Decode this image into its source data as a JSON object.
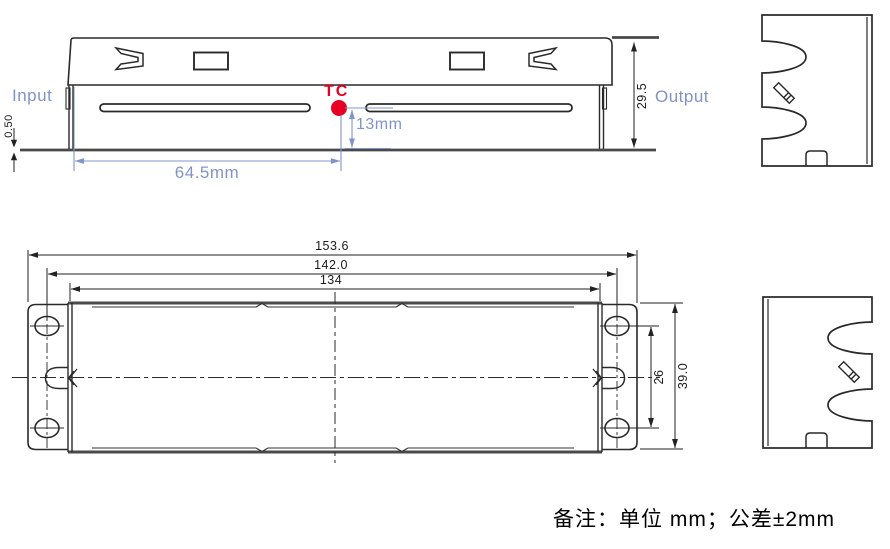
{
  "drawing_title": "enclosure-dimension-drawing",
  "colors": {
    "dimension_blue": "#8094c8",
    "accent_red": "#e60021",
    "line_dark": "#222222",
    "line_thick_gray": "#4a4a4a"
  },
  "side_view": {
    "input_label": "Input",
    "output_label": "Output",
    "tc_label": "TC",
    "dim_tc_to_base": "13mm",
    "dim_tc_from_input_end": "64.5mm",
    "dim_baseplate_thickness": "0.50",
    "dim_overall_height": "29.5"
  },
  "plan_view": {
    "dim_overall_length": "153.6",
    "dim_mounting_hole_pitch_length": "142.0",
    "dim_body_length": "134",
    "dim_mounting_hole_pitch_width": "26",
    "dim_overall_width": "39.0"
  },
  "footer": {
    "note": "备注：单位 mm；公差±2mm"
  }
}
